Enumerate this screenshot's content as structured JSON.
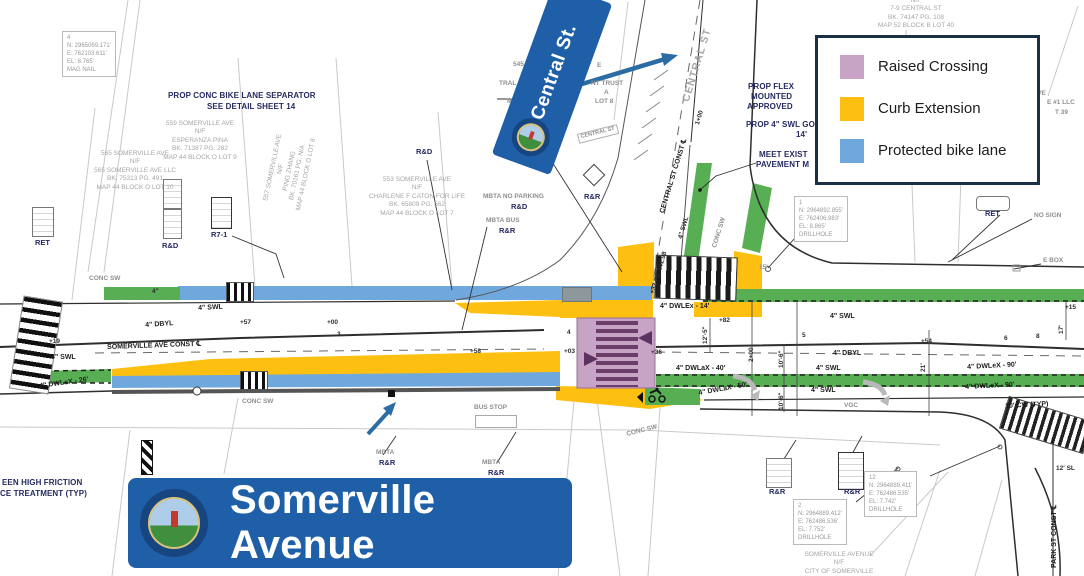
{
  "legend": {
    "items": [
      {
        "label": "Raised Crossing",
        "color": "#c7a4c6"
      },
      {
        "label": "Curb Extension",
        "color": "#fdc010"
      },
      {
        "label": "Protected bike lane",
        "color": "#6fa8dc"
      }
    ]
  },
  "banners": {
    "central_st": {
      "label": "Central St."
    },
    "somerville_avenue": {
      "label": "Somerville Avenue"
    }
  },
  "colors": {
    "banner_blue": "#1e5fa8",
    "legend_border": "#1b2f45",
    "raised_crossing": "#c7a4c6",
    "curb_extension": "#fdc010",
    "protected_bike_lane": "#6fa8dc",
    "bike_lane_green": "#57ae53",
    "annotation_arrow": "#2b6ca3",
    "callout_text": "#252a61"
  },
  "plan": {
    "labels": [
      {
        "t": "PROP CONC BIKE LANE SEPARATOR",
        "x": 168,
        "y": 92,
        "c": "callout"
      },
      {
        "t": "SEE DETAIL SHEET 14",
        "x": 207,
        "y": 103,
        "c": "callout"
      },
      {
        "t": "PROP FLEX",
        "x": 748,
        "y": 83,
        "c": "callout"
      },
      {
        "t": "MOUNTED",
        "x": 751,
        "y": 93,
        "c": "callout"
      },
      {
        "t": "APPROVED",
        "x": 747,
        "y": 103,
        "c": "callout"
      },
      {
        "t": "PROP 4\" SWL GO",
        "x": 746,
        "y": 121,
        "c": "callout"
      },
      {
        "t": "14'",
        "x": 796,
        "y": 131,
        "c": "callout"
      },
      {
        "t": "MEET EXIST",
        "x": 759,
        "y": 151,
        "c": "callout"
      },
      {
        "t": "PAVEMENT M",
        "x": 756,
        "y": 161,
        "c": "callout"
      },
      {
        "t": "EEN HIGH FRICTION",
        "x": 2,
        "y": 479,
        "c": "callout"
      },
      {
        "t": "CE TREATMENT (TYP)",
        "x": 0,
        "y": 490,
        "c": "callout"
      },
      {
        "t": "RET",
        "x": 35,
        "y": 239,
        "c": "sign"
      },
      {
        "t": "R&D",
        "x": 162,
        "y": 242,
        "c": "sign"
      },
      {
        "t": "R7-1",
        "x": 211,
        "y": 231,
        "c": "sign"
      },
      {
        "t": "R&D",
        "x": 416,
        "y": 148,
        "c": "sign"
      },
      {
        "t": "R&D",
        "x": 511,
        "y": 203,
        "c": "sign"
      },
      {
        "t": "R&R",
        "x": 499,
        "y": 227,
        "c": "sign"
      },
      {
        "t": "R&R",
        "x": 584,
        "y": 193,
        "c": "sign"
      },
      {
        "t": "R&R",
        "x": 379,
        "y": 459,
        "c": "sign"
      },
      {
        "t": "R&R",
        "x": 488,
        "y": 469,
        "c": "sign"
      },
      {
        "t": "R&R",
        "x": 769,
        "y": 488,
        "c": "sign"
      },
      {
        "t": "R&R",
        "x": 844,
        "y": 488,
        "c": "sign"
      },
      {
        "t": "RET",
        "x": 985,
        "y": 210,
        "c": "sign"
      },
      {
        "t": "MBTA NO PARKING",
        "x": 483,
        "y": 194,
        "c": "gray"
      },
      {
        "t": "MBTA BUS",
        "x": 486,
        "y": 218,
        "c": "gray"
      },
      {
        "t": "MBTA",
        "x": 376,
        "y": 450,
        "c": "gray"
      },
      {
        "t": "MBTA",
        "x": 482,
        "y": 460,
        "c": "gray"
      },
      {
        "t": "BUS STOP",
        "x": 474,
        "y": 405,
        "c": "gray"
      },
      {
        "t": "CONC SW",
        "x": 89,
        "y": 276,
        "c": "gray"
      },
      {
        "t": "CONC SW",
        "x": 242,
        "y": 399,
        "c": "gray"
      },
      {
        "t": "CONC SW",
        "x": 626,
        "y": 432,
        "c": "gray",
        "r": -14
      },
      {
        "t": "CONC SW",
        "x": 712,
        "y": 247,
        "c": "gray",
        "r": -73
      },
      {
        "t": "VGC",
        "x": 844,
        "y": 403,
        "c": "gray"
      },
      {
        "t": "NO SIGN",
        "x": 1034,
        "y": 213,
        "c": "gray"
      },
      {
        "t": "E BOX",
        "x": 1043,
        "y": 258,
        "c": "gray"
      },
      {
        "t": "15'",
        "x": 759,
        "y": 265,
        "c": "gray"
      },
      {
        "t": "CENTRAL ST",
        "x": 681,
        "y": 100,
        "c": "street",
        "r": -73
      },
      {
        "t": "CENTRAL ST",
        "x": 577,
        "y": 134,
        "c": "boxed",
        "r": -14
      },
      {
        "t": "4\" SWL",
        "x": 51,
        "y": 354,
        "c": "lane"
      },
      {
        "t": "4\" DWLeX - 26'",
        "x": 39,
        "y": 383,
        "c": "lane",
        "r": -8
      },
      {
        "t": "+19",
        "x": 49,
        "y": 339,
        "c": "tick"
      },
      {
        "t": "4\" DBYL",
        "x": 145,
        "y": 322,
        "c": "lane",
        "r": -4
      },
      {
        "t": "SOMERVILLE AVE CONST ℄",
        "x": 107,
        "y": 344,
        "c": "lane",
        "r": -2
      },
      {
        "t": "4\" SWL",
        "x": 198,
        "y": 305,
        "c": "lane",
        "r": -3
      },
      {
        "t": "+57",
        "x": 240,
        "y": 320,
        "c": "tick"
      },
      {
        "t": "+00",
        "x": 327,
        "y": 320,
        "c": "tick"
      },
      {
        "t": "3",
        "x": 337,
        "y": 332,
        "c": "tick"
      },
      {
        "t": "+58",
        "x": 470,
        "y": 349,
        "c": "tick"
      },
      {
        "t": "+03",
        "x": 564,
        "y": 349,
        "c": "tick"
      },
      {
        "t": "4",
        "x": 567,
        "y": 330,
        "c": "tick"
      },
      {
        "t": "+36",
        "x": 651,
        "y": 350,
        "c": "tick"
      },
      {
        "t": "4\" DWLEx - 14'",
        "x": 660,
        "y": 303,
        "c": "lane"
      },
      {
        "t": "+82",
        "x": 719,
        "y": 318,
        "c": "tick"
      },
      {
        "t": "12'-5\"",
        "x": 703,
        "y": 344,
        "c": "tick",
        "r": -90
      },
      {
        "t": "2+00",
        "x": 749,
        "y": 362,
        "c": "tick",
        "r": -90
      },
      {
        "t": "10'-6\"",
        "x": 779,
        "y": 368,
        "c": "tick",
        "r": -90
      },
      {
        "t": "10'-6\"",
        "x": 779,
        "y": 410,
        "c": "tick",
        "r": -90
      },
      {
        "t": "5",
        "x": 802,
        "y": 333,
        "c": "tick"
      },
      {
        "t": "+54",
        "x": 921,
        "y": 339,
        "c": "tick"
      },
      {
        "t": "4\" DBYL",
        "x": 833,
        "y": 350,
        "c": "lane"
      },
      {
        "t": "4\" SWL",
        "x": 830,
        "y": 313,
        "c": "lane"
      },
      {
        "t": "4\" DWLaX - 40'",
        "x": 676,
        "y": 365,
        "c": "lane"
      },
      {
        "t": "4\" SWL",
        "x": 816,
        "y": 365,
        "c": "lane"
      },
      {
        "t": "4\" SWL",
        "x": 811,
        "y": 387,
        "c": "lane"
      },
      {
        "t": "4\" DWLaX - 50'",
        "x": 698,
        "y": 390,
        "c": "lane",
        "r": -10
      },
      {
        "t": "4\" DWLeX - 90'",
        "x": 967,
        "y": 364,
        "c": "lane",
        "r": -3
      },
      {
        "t": "4\" DWLeX - 90'",
        "x": 965,
        "y": 384,
        "c": "lane",
        "r": -3
      },
      {
        "t": "10' CW (TYP)",
        "x": 1005,
        "y": 403,
        "c": "lane",
        "r": -3
      },
      {
        "t": "+15",
        "x": 1065,
        "y": 305,
        "c": "tick"
      },
      {
        "t": "17'",
        "x": 1059,
        "y": 334,
        "c": "tick",
        "r": -90
      },
      {
        "t": "8",
        "x": 1036,
        "y": 334,
        "c": "tick"
      },
      {
        "t": "6",
        "x": 1004,
        "y": 336,
        "c": "tick"
      },
      {
        "t": "21'",
        "x": 921,
        "y": 372,
        "c": "tick",
        "r": -90
      },
      {
        "t": "CENTRAL ST CONST ℄",
        "x": 659,
        "y": 212,
        "c": "lane",
        "r": -73
      },
      {
        "t": "1+00",
        "x": 695,
        "y": 124,
        "c": "tick",
        "r": -73
      },
      {
        "t": "4\" SWL",
        "x": 678,
        "y": 238,
        "c": "tick",
        "r": -73
      },
      {
        "t": "+32 PC +41.98",
        "x": 650,
        "y": 293,
        "c": "tick",
        "r": -73
      },
      {
        "t": "4\"",
        "x": 152,
        "y": 289,
        "c": "tick"
      },
      {
        "t": "12' SL",
        "x": 1056,
        "y": 466,
        "c": "tick"
      },
      {
        "t": "PARK ST CONST ℄",
        "x": 1051,
        "y": 568,
        "c": "lane",
        "r": -90
      },
      {
        "t": "AVE",
        "x": 1033,
        "y": 91,
        "c": "gray"
      },
      {
        "t": "E #1 LLC",
        "x": 1047,
        "y": 100,
        "c": "gray"
      },
      {
        "t": "T 39",
        "x": 1055,
        "y": 110,
        "c": "gray"
      },
      {
        "t": "545 S",
        "x": 513,
        "y": 62,
        "c": "gray"
      },
      {
        "t": "E",
        "x": 597,
        "y": 63,
        "c": "gray"
      },
      {
        "t": "TRAL ST",
        "x": 499,
        "y": 81,
        "c": "gray"
      },
      {
        "t": "NT TRUST",
        "x": 591,
        "y": 81,
        "c": "gray"
      },
      {
        "t": "BK.",
        "x": 523,
        "y": 90,
        "c": "gray"
      },
      {
        "t": "A",
        "x": 604,
        "y": 90,
        "c": "gray"
      },
      {
        "t": "MAP 4",
        "x": 507,
        "y": 99,
        "c": "gray"
      },
      {
        "t": "LOT 8",
        "x": 595,
        "y": 99,
        "c": "gray"
      }
    ],
    "parcels": [
      {
        "cx": 135,
        "y": 150,
        "lines": [
          "565 SOMERVILLE AVE",
          "N/F",
          "565 SOMERVILLE AVE LLC",
          "BK. 75313 PG. 491",
          "MAP 44 BLOCK O LOT 10"
        ]
      },
      {
        "cx": 200,
        "y": 120,
        "lines": [
          "559 SOMERVILLE AVE",
          "N/F",
          "ESPERANZA PINA",
          "BK. 71387 PG. 282",
          "MAP 44 BLOCK O LOT 9"
        ]
      },
      {
        "cx": 417,
        "y": 176,
        "lines": [
          "553 SOMERVILLE AVE",
          "N/F",
          "CHARLENE F CATON FOR LIFE",
          "BK. 65809 PG. 562",
          "MAP 44 BLOCK O LOT 7"
        ]
      },
      {
        "cx": 290,
        "y": 150,
        "r": -78,
        "lines": [
          "557 SOMERVILLE AVE",
          "N/F",
          "PING ZHANG",
          "BK. 70161 PG. N/A",
          "MAP 44 BLOCK O LOT 8"
        ]
      },
      {
        "cx": 916,
        "y": -3,
        "lines": [
          "N/F",
          "7-9 CENTRAL ST",
          "BK. 74147 PG. 108",
          "MAP 52 BLOCK B LOT 40"
        ]
      },
      {
        "cx": 839,
        "y": 551,
        "lines": [
          "SOMERVILLE AVENUE",
          "N/F",
          "CITY OF SOMERVILLE"
        ]
      }
    ],
    "databoxes": [
      {
        "x": 62,
        "y": 31,
        "lines": [
          "4",
          "N: 2965069.171'",
          "E: 762103.611'",
          "EL: 8.765'",
          "MAG NAIL"
        ]
      },
      {
        "x": 794,
        "y": 196,
        "lines": [
          "1",
          "N: 2964892.855'",
          "E: 762406.983'",
          "EL: 8.865'",
          "DRILLHOLE"
        ]
      },
      {
        "x": 864,
        "y": 471,
        "lines": [
          "12",
          "N: 2964889.411'",
          "E: 762486.535'",
          "EL: 7.742'",
          "DRILLHOLE"
        ]
      },
      {
        "x": 793,
        "y": 499,
        "lines": [
          "2",
          "N: 2964889.412'",
          "E: 762486.536'",
          "EL: 7.752'",
          "DRILLHOLE"
        ]
      }
    ]
  }
}
